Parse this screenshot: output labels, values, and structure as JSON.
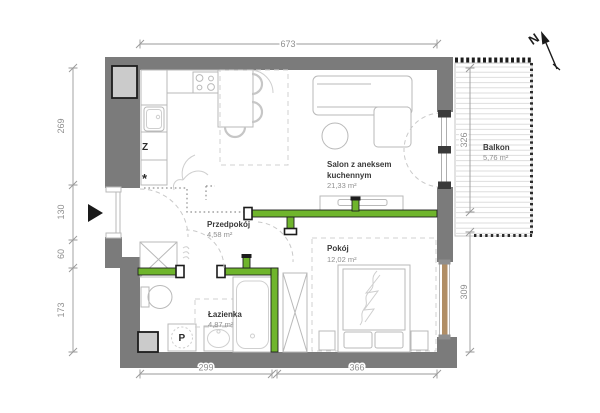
{
  "plan": {
    "compass": {
      "label": "N"
    },
    "rooms": {
      "salon": {
        "name1": "Salon z aneksem",
        "name2": "kuchennym",
        "area": "21,33 m²"
      },
      "przedpokoj": {
        "name": "Przedpokój",
        "area": "4,58 m²"
      },
      "pokoj": {
        "name": "Pokój",
        "area": "12,02 m²"
      },
      "lazienka": {
        "name": "Łazienka",
        "area": "4,87 m²"
      },
      "balkon": {
        "name": "Balkon",
        "area": "5,76 m²"
      }
    },
    "dims": {
      "top": "673",
      "left": [
        "269",
        "130",
        "60",
        "173"
      ],
      "right": [
        "326",
        "309"
      ],
      "bottom": [
        "299",
        "366"
      ]
    },
    "appliances": {
      "dishwasher_label": "Z",
      "star_label": "*",
      "washer_label": "P"
    },
    "colors": {
      "wall": "#7b7b7b",
      "accent_green": "#6fb52c",
      "window_tan": "#b08e66",
      "shaft_fill": "#cbcbcb"
    }
  }
}
